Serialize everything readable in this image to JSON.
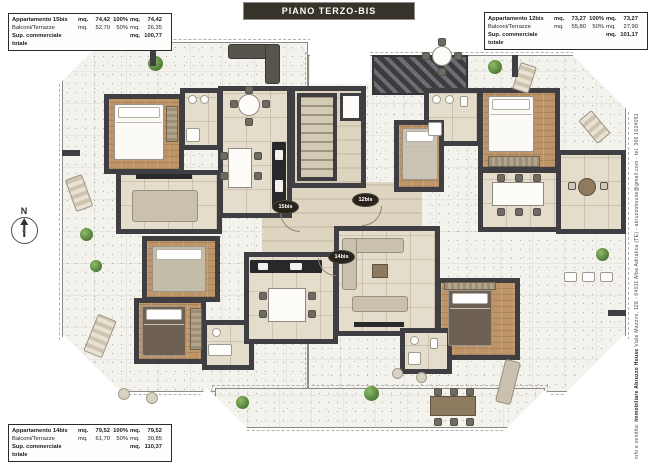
{
  "title_bar": {
    "label": "PIANO TERZO-BIS"
  },
  "info_boxes": [
    {
      "id": "15bis",
      "rows": [
        {
          "label": "Appartamento 15bis",
          "u1": "mq.",
          "v1": "74,42",
          "pct": "100%",
          "u2": "mq.",
          "v2": "74,42"
        },
        {
          "label": "Balconi/Terrazze",
          "u1": "mq.",
          "v1": "52,70",
          "pct": "50%",
          "u2": "mq.",
          "v2": "26,35"
        },
        {
          "label": "Sup. commerciale totale",
          "u1": "",
          "v1": "",
          "pct": "",
          "u2": "mq.",
          "v2": "100,77"
        }
      ]
    },
    {
      "id": "12bis",
      "rows": [
        {
          "label": "Appartamento 12bis",
          "u1": "mq.",
          "v1": "73,27",
          "pct": "100%",
          "u2": "mq.",
          "v2": "73,27"
        },
        {
          "label": "Balconi/Terrazze",
          "u1": "mq.",
          "v1": "55,80",
          "pct": "50%",
          "u2": "mq.",
          "v2": "27,90"
        },
        {
          "label": "Sup. commerciale totale",
          "u1": "",
          "v1": "",
          "pct": "",
          "u2": "mq.",
          "v2": "101,17"
        }
      ]
    },
    {
      "id": "14bis",
      "rows": [
        {
          "label": "Appartamento 14bis",
          "u1": "mq.",
          "v1": "79,52",
          "pct": "100%",
          "u2": "mq.",
          "v2": "79,52"
        },
        {
          "label": "Balconi/Terrazze",
          "u1": "mq.",
          "v1": "61,70",
          "pct": "50%",
          "u2": "mq.",
          "v2": "30,85"
        },
        {
          "label": "Sup. commerciale totale",
          "u1": "",
          "v1": "",
          "pct": "",
          "u2": "mq.",
          "v2": "110,37"
        }
      ]
    }
  ],
  "unit_markers": [
    {
      "label": "15bis"
    },
    {
      "label": "12bis"
    },
    {
      "label": "14bis"
    }
  ],
  "compass": {
    "label": "N"
  },
  "contact_strip": {
    "prefix": "info e vendita: ",
    "agency": "Immobiliare Abruzzo House",
    "rest": " Viale Mazzini, 128 - 64011 Alba Adriatica (TE) - abruzzohouse@gmail.com - tel. 366 1624051"
  },
  "colors": {
    "wall": "#3e3e43",
    "wood_floor": "#bd9569",
    "tile_floor": "#e4ddcc",
    "terrace": "#f4f2ed",
    "title_bg": "#38332a",
    "plant": "#4f7d35"
  }
}
